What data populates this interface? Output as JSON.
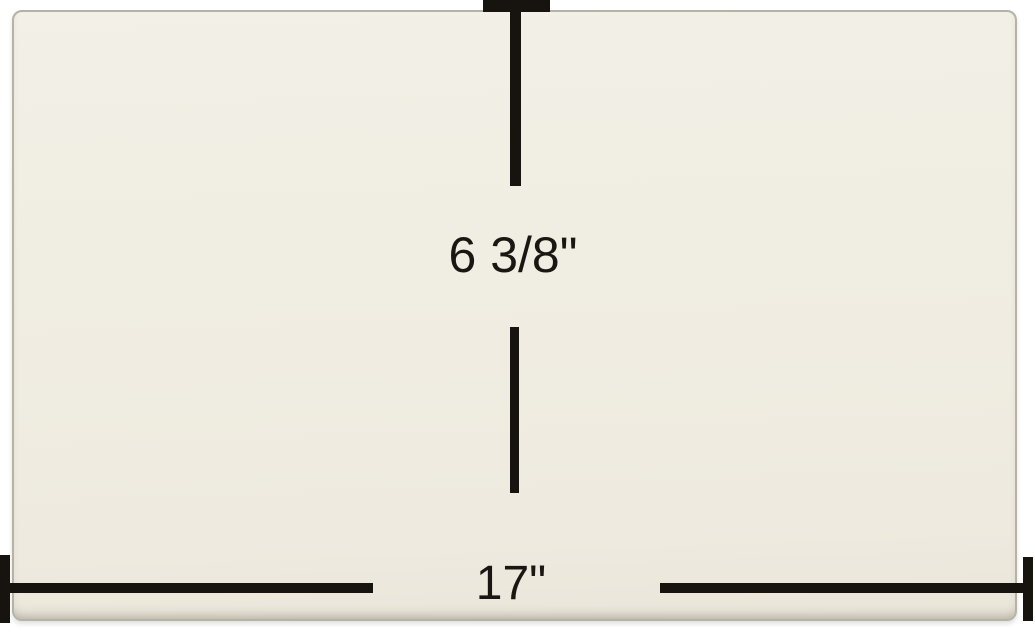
{
  "diagram": {
    "height_label": "6 3/8\"",
    "width_label": "17\""
  },
  "colors": {
    "background": "#ffffff",
    "panel_fill": "#f0ede2",
    "panel_edge": "#b7b2a4",
    "dimension_line": "#17130e",
    "label_text": "#1a1713"
  }
}
